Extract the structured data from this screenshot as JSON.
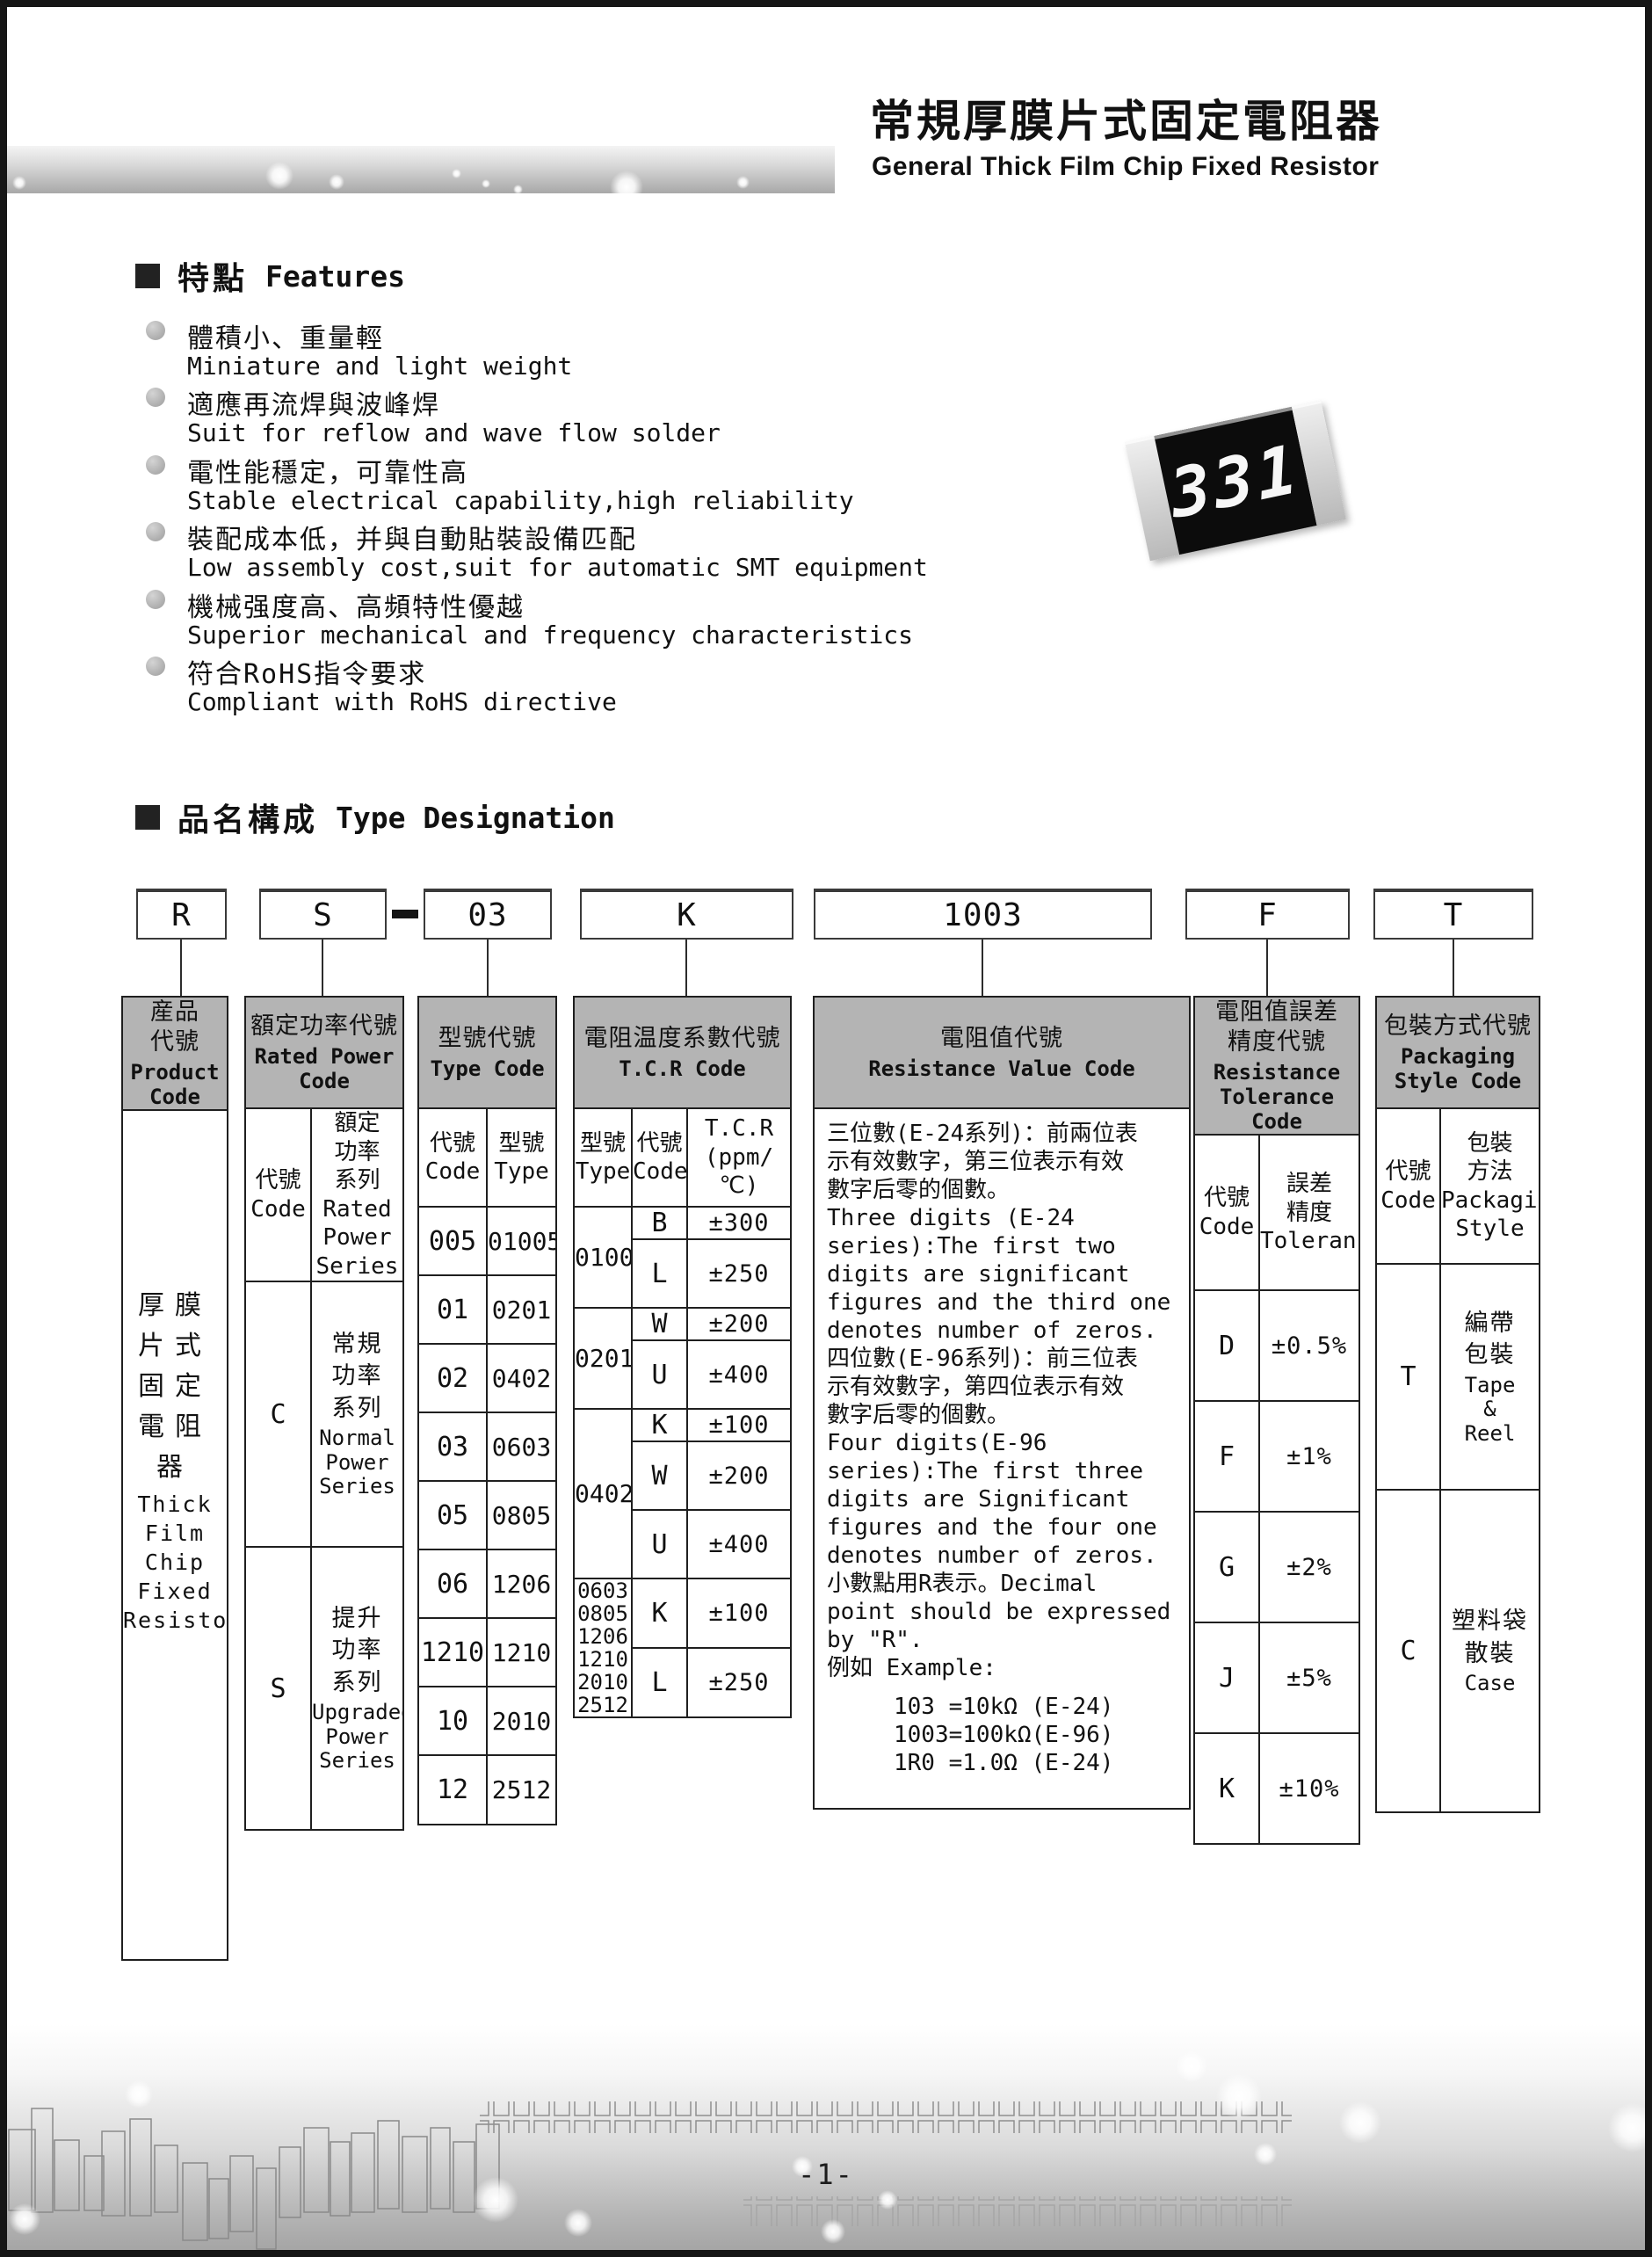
{
  "masthead": {
    "title_zh": "常規厚膜片式固定電阻器",
    "title_en": "General Thick Film Chip Fixed Resistor"
  },
  "chip": {
    "marking": "331"
  },
  "features": {
    "heading_zh": "特點",
    "heading_en": "Features",
    "items": [
      {
        "zh": "體積小、重量輕",
        "en": "Miniature and light weight"
      },
      {
        "zh": "適應再流焊與波峰焊",
        "en": "Suit for reflow and wave flow solder"
      },
      {
        "zh": "電性能穩定，可靠性高",
        "en": "Stable electrical capability,high reliability"
      },
      {
        "zh": "裝配成本低，并與自動貼裝設備匹配",
        "en": "Low assembly cost,suit for automatic SMT equipment"
      },
      {
        "zh": "機械强度高、高頻特性優越",
        "en": "Superior mechanical and frequency characteristics"
      },
      {
        "zh": "符合RoHS指令要求",
        "en": "Compliant with RoHS directive"
      }
    ]
  },
  "designation": {
    "heading_zh": "品名構成",
    "heading_en": "Type Designation",
    "boxes": [
      "R",
      "S",
      "03",
      "K",
      "1003",
      "F",
      "T"
    ]
  },
  "table": {
    "product": {
      "header_zh": "産品\n代號",
      "header_en": "Product\nCode",
      "body_zh": "厚膜\n片式\n固定\n電阻器",
      "body_en": "Thick\nFilm\nChip\nFixed\nResistor"
    },
    "rated_power": {
      "header_zh": "額定功率代號",
      "header_en": "Rated Power\nCode",
      "sub_code": "代號\nCode",
      "sub_series": "額定\n功率\n系列\nRated\nPower\nSeries",
      "rows": [
        {
          "code": "C",
          "zh": "常規\n功率\n系列",
          "en": "Normal\nPower\nSeries"
        },
        {
          "code": "S",
          "zh": "提升\n功率\n系列",
          "en": "Upgraded\nPower\nSeries"
        }
      ]
    },
    "type_code": {
      "header_zh": "型號代號",
      "header_en": "Type Code",
      "sub_code": "代號\nCode",
      "sub_type": "型號\nType",
      "rows": [
        {
          "code": "005",
          "type": "01005"
        },
        {
          "code": "01",
          "type": "0201"
        },
        {
          "code": "02",
          "type": "0402"
        },
        {
          "code": "03",
          "type": "0603"
        },
        {
          "code": "05",
          "type": "0805"
        },
        {
          "code": "06",
          "type": "1206"
        },
        {
          "code": "1210",
          "type": "1210"
        },
        {
          "code": "10",
          "type": "2010"
        },
        {
          "code": "12",
          "type": "2512"
        }
      ]
    },
    "tcr": {
      "header_zh": "電阻温度系數代號",
      "header_en": "T.C.R Code",
      "sub_type": "型號\nType",
      "sub_code": "代號\nCode",
      "sub_value": "T.C.R\n(ppm/℃)",
      "groups": [
        {
          "type": "01005",
          "rows": [
            {
              "code": "B",
              "value": "±300"
            },
            {
              "code": "L",
              "value": "±250"
            }
          ]
        },
        {
          "type": "0201",
          "rows": [
            {
              "code": "W",
              "value": "±200"
            },
            {
              "code": "U",
              "value": "±400"
            }
          ]
        },
        {
          "type": "0402",
          "rows": [
            {
              "code": "K",
              "value": "±100"
            },
            {
              "code": "W",
              "value": "±200"
            },
            {
              "code": "U",
              "value": "±400"
            }
          ]
        },
        {
          "type": "0603\n0805\n1206\n1210\n2010\n2512",
          "rows": [
            {
              "code": "K",
              "value": "±100"
            },
            {
              "code": "L",
              "value": "±250"
            }
          ]
        }
      ]
    },
    "resistance_value": {
      "header_zh": "電阻值代號",
      "header_en": "Resistance Value Code",
      "body": "三位數(E-24系列)：前兩位表\n示有效數字，第三位表示有效\n數字后零的個數。\nThree digits (E-24\nseries):The first two\ndigits are significant\nfigures and the third one\ndenotes number of zeros.\n四位數(E-96系列)：前三位表\n示有效數字，第四位表示有效\n數字后零的個數。\nFour digits(E-96\nseries):The first three\ndigits are Significant\nfigures and the four one\ndenotes number of zeros.\n小數點用R表示。Decimal\npoint should be expressed\nby \"R\".\n例如 Example:",
      "examples": "103 =10kΩ (E-24)\n1003=100kΩ(E-96)\n1R0 =1.0Ω (E-24)"
    },
    "tolerance": {
      "header_zh": "電阻值誤差\n精度代號",
      "header_en": "Resistance\nTolerance Code",
      "sub_code": "代號\nCode",
      "sub_tol": "誤差\n精度\nTolerance",
      "rows": [
        {
          "code": "D",
          "value": "±0.5%"
        },
        {
          "code": "F",
          "value": "±1%"
        },
        {
          "code": "G",
          "value": "±2%"
        },
        {
          "code": "J",
          "value": "±5%"
        },
        {
          "code": "K",
          "value": "±10%"
        }
      ]
    },
    "packaging": {
      "header_zh": "包裝方式代號",
      "header_en": "Packaging\nStyle Code",
      "sub_code": "代號\nCode",
      "sub_style": "包裝\n方法\nPackaging\nStyle",
      "rows": [
        {
          "code": "T",
          "zh": "編帶\n包裝",
          "en": "Tape\n&\nReel"
        },
        {
          "code": "C",
          "zh": "塑料袋\n散裝",
          "en": "Case"
        }
      ]
    }
  },
  "footer": {
    "page_number": "-1-"
  }
}
